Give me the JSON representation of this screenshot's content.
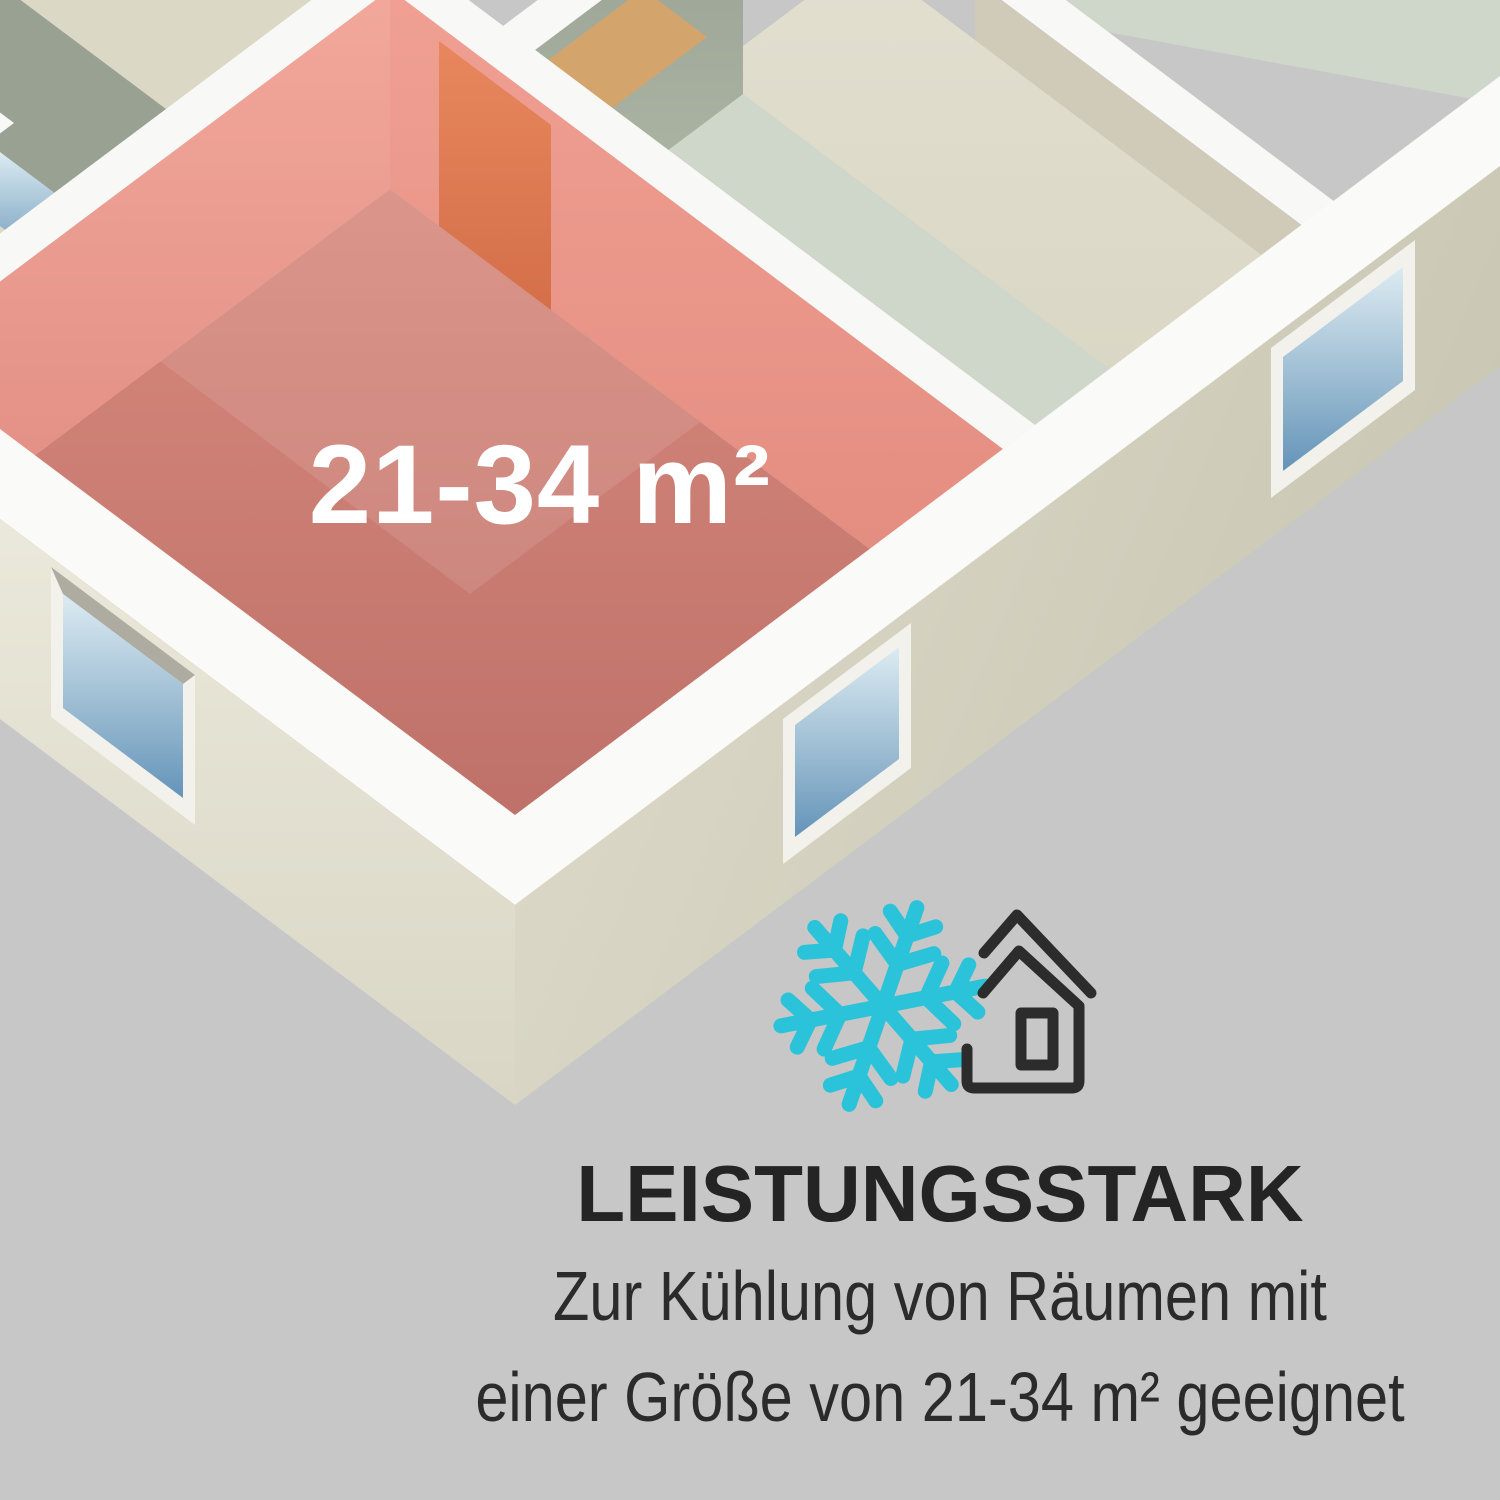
{
  "scene": {
    "background_color": "#c6c7c6",
    "kind": "air-conditioner product infographic with isometric floor plan"
  },
  "floorplan": {
    "area_label": "21-34 m²",
    "highlight_room_wall_color": "#ec9a8d",
    "highlight_room_floor_color": "#c1736b",
    "door_color": "#dd7a51",
    "wall_top_color": "#f8f8f6",
    "exterior_wall_color": "#ddd9c9",
    "neighbor_wall_color": "#a3ab9c",
    "floor_beige_color": "#ddd9c7",
    "floor_mint_color": "#ced7ca",
    "window_glass_top_color": "#dcebf2",
    "window_glass_bottom_color": "#6494b9",
    "cabinet_patch_color": "#d3a56c"
  },
  "callout": {
    "heading": "LEISTUNGSSTARK",
    "description_line1": "Zur Kühlung von Räumen mit",
    "description_line2": "einer Größe von 21-34 m² geeignet",
    "snowflake_color": "#2bc3da",
    "house_outline_color": "#2c2c2c",
    "text_color": "#2b2b2b"
  }
}
